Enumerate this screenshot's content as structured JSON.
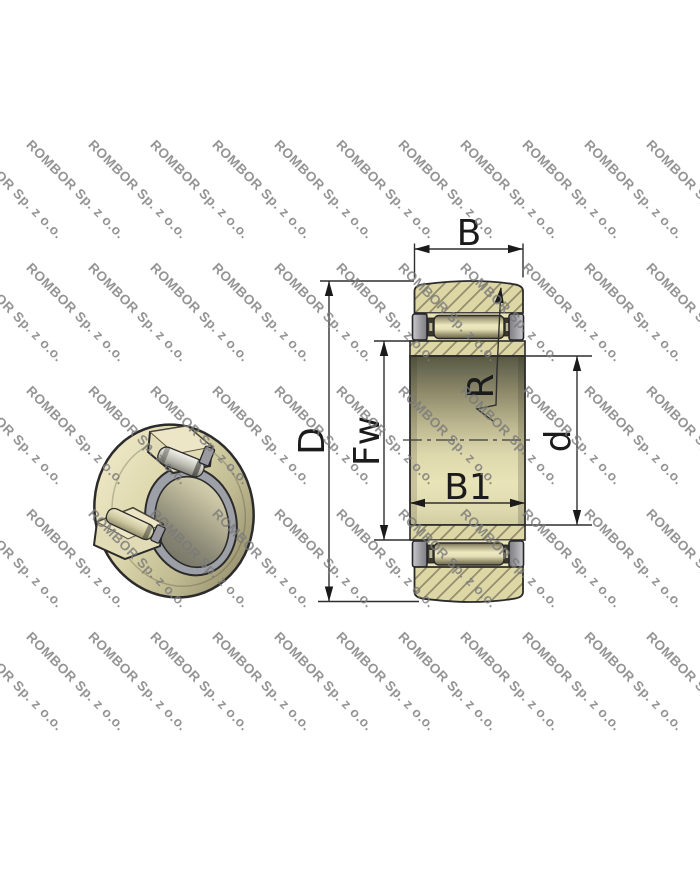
{
  "page": {
    "background": "#ffffff",
    "width": 700,
    "height": 869
  },
  "watermark": {
    "text": "ROMBOR Sp. z o.o.",
    "color": "#7a7a7a",
    "opacity": 0.8,
    "font_size_px": 13.5,
    "angle_deg": 45,
    "rows": 5,
    "cols": 12,
    "start_x": -28,
    "start_y": 137,
    "col_spacing": 62,
    "row_spacing": 123
  },
  "drawing": {
    "type": "yoke-track-roller-bearing technical drawing",
    "views": {
      "left": "3D cutaway render of bearing",
      "right": "cross-section with dimensions"
    },
    "dimension_labels": {
      "outer_width": "B",
      "outer_diameter": "D",
      "roller_inscribed_diameter": "Fw",
      "inner_ring_width": "B1",
      "crown_radius": "R",
      "bore_diameter": "d"
    },
    "colors": {
      "body_tan": "#ddd7a6",
      "hatch_line": "#938c6d",
      "steel_gray": "#9c9ca2",
      "outline": "#2b2b2b",
      "dimension_line": "#2f2f2f",
      "label_text": "#1b1b1b"
    }
  }
}
